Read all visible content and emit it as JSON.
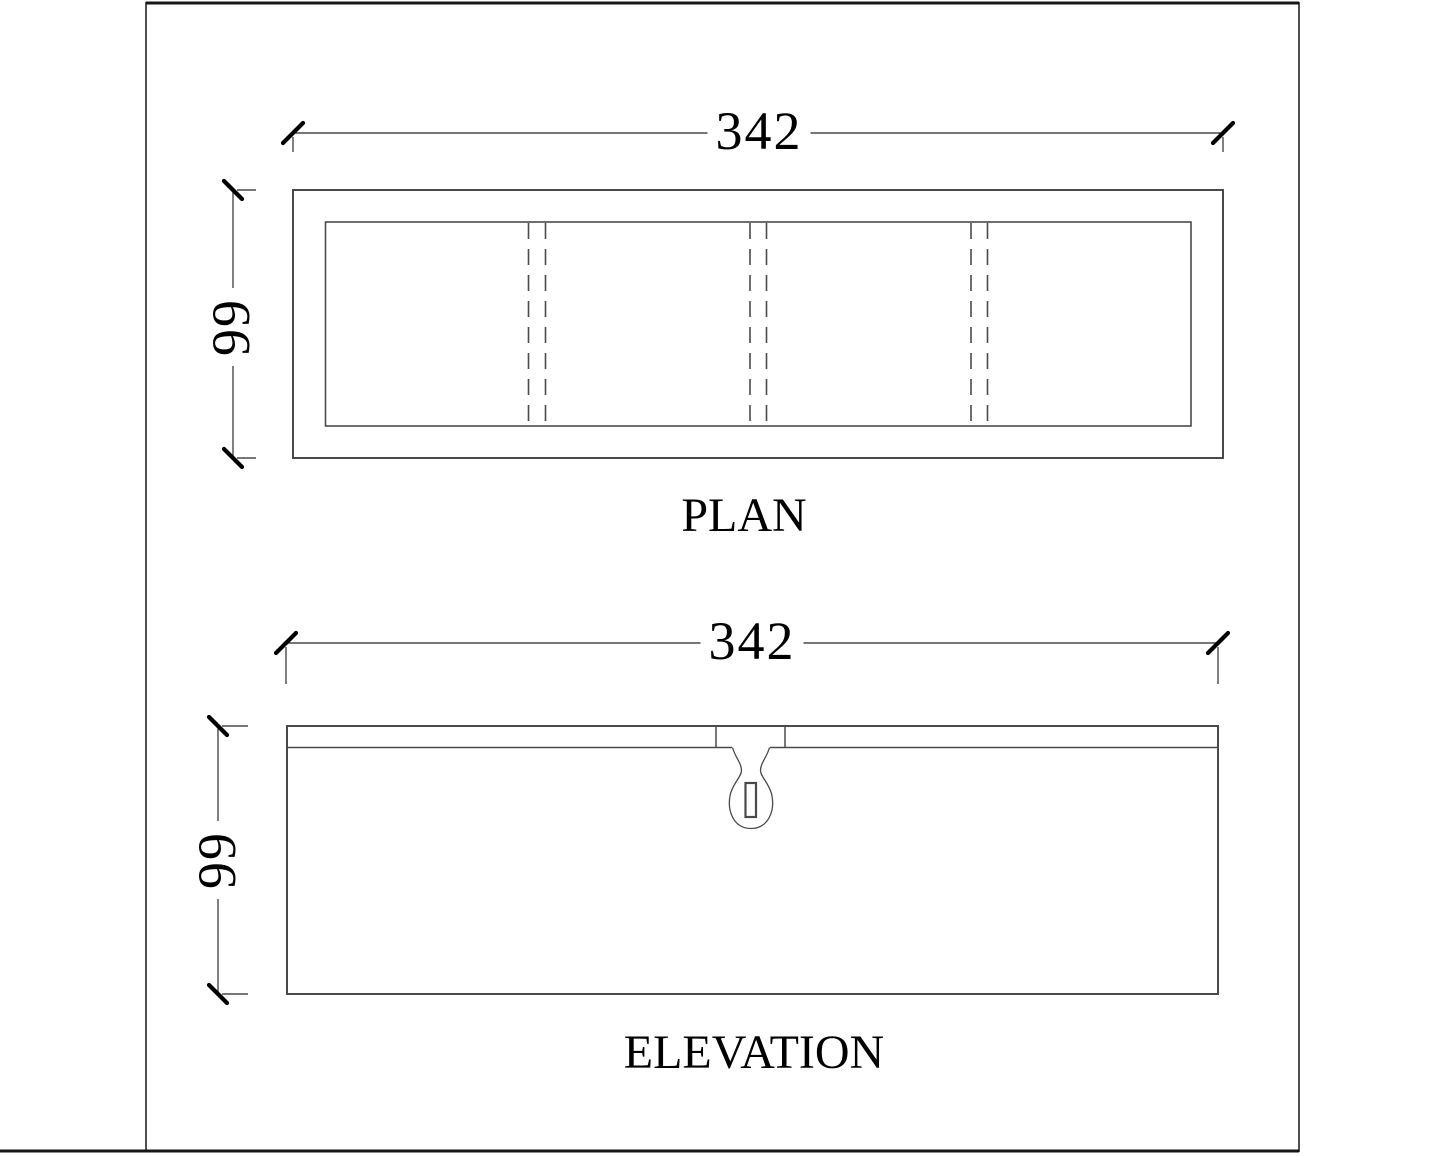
{
  "colors": {
    "line": "#4a4a4a",
    "tick": "#000000",
    "text": "#000000",
    "frame": "#4f4f4f",
    "frame_accent": "#161616"
  },
  "plan": {
    "title": "PLAN",
    "dimensions": {
      "width": "342",
      "depth": "99"
    }
  },
  "elevation": {
    "title": "ELEVATION",
    "dimensions": {
      "width": "342",
      "height": "99"
    }
  }
}
